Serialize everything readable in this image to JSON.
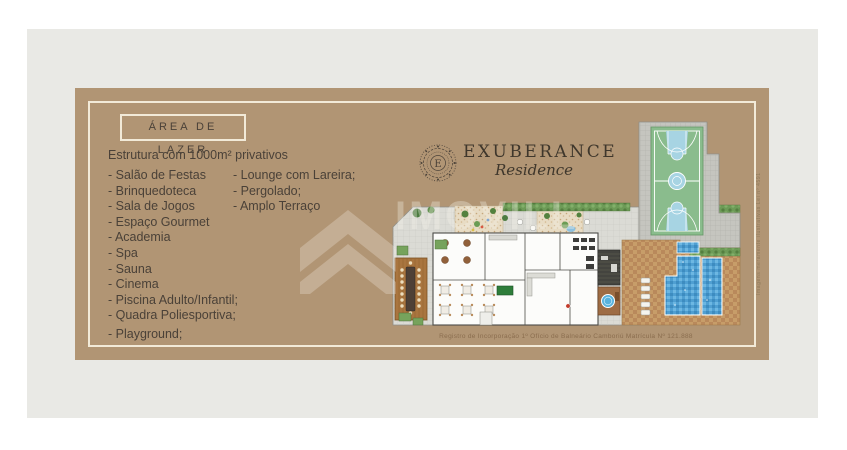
{
  "palette": {
    "background": "#ffffff",
    "panel": "#e9e9e5",
    "card": "#b19574",
    "frame_cream": "#f2ead8",
    "text_dark": "#4a4138",
    "court_green": "#8abc8d",
    "court_key_blue": "#a7d4e3",
    "water_blue": "#4f9fd2",
    "deck_tan": "#c79d69"
  },
  "leisure": {
    "title": "ÁREA DE LAZER",
    "subtitle": "Estrutura com 1000m² privativos",
    "column1": [
      "- Salão de Festas",
      "- Brinquedoteca",
      "- Sala de Jogos",
      "- Espaço Gourmet",
      "- Academia",
      "- Spa",
      "- Sauna",
      "- Cinema",
      "- Piscina Adulto/Infantil;",
      "- Quadra Poliesportiva;",
      "- Playground;"
    ],
    "column2": [
      "- Lounge com Lareira;",
      "- Pergolado;",
      "- Amplo Terraço"
    ]
  },
  "brand": {
    "name": "EXUBERANCE",
    "subname": "Residence",
    "emblem_letter": "E"
  },
  "footer": {
    "registration": "Registro de Incorporação 1º Ofício de Balneário Camboriú Matrícula Nº 121.888"
  },
  "watermark": {
    "text": "IMOVILL"
  },
  "side_note": {
    "text": "Imagens meramente ilustrativas Lei nº 4591"
  }
}
